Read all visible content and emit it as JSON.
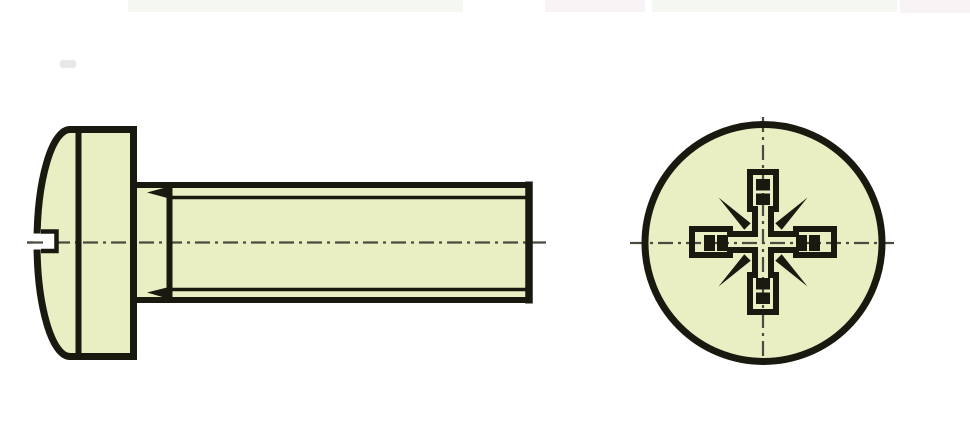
{
  "figure": {
    "description": "Technical line drawing of a pan head machine screw with Pozidriv cross recess: side elevation on the left, head end view on the right",
    "views": [
      {
        "name": "side-view",
        "depicts": "domed pan head with recess notch, neck, thread run-out and fully threaded shank with flat end"
      },
      {
        "name": "end-view",
        "depicts": "circular head outline with Pozidriv cross recess, wing marks and 45-degree identification ticks"
      }
    ]
  },
  "colors": {
    "background": "#ffffff",
    "part_fill": "#e9efc3",
    "line": "#1a1910",
    "centerline": "#4b4a3e"
  }
}
